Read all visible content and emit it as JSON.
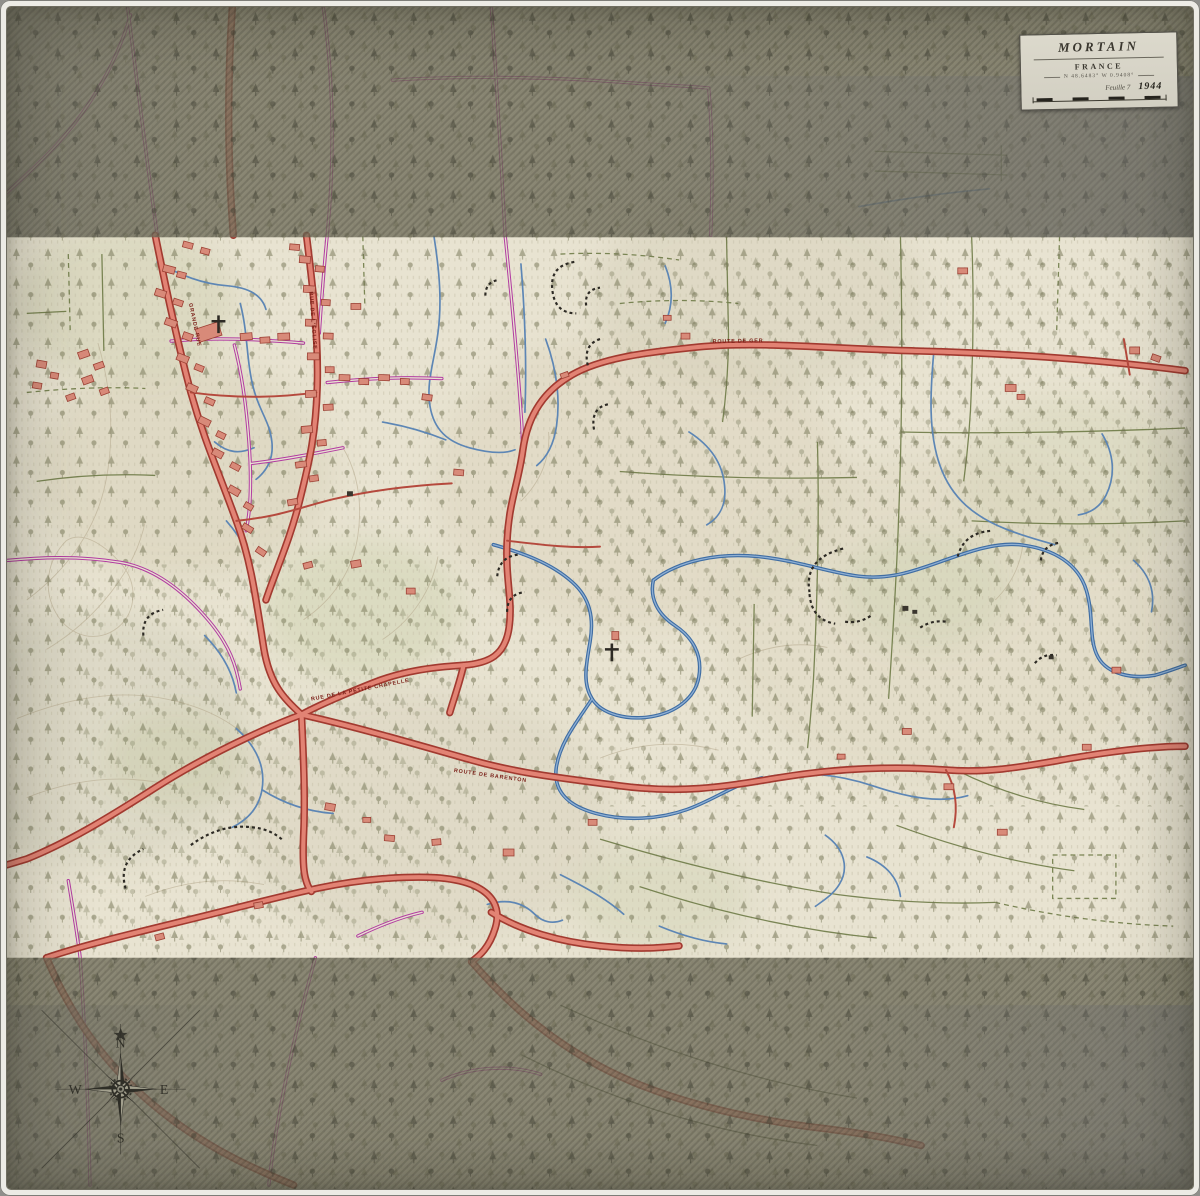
{
  "cartouche": {
    "title": "MORTAIN",
    "country": "FRANCE",
    "coordinates": "N 48.6483°  W 0.9408°",
    "edition": "Feuille 7",
    "year": "1944"
  },
  "compass": {
    "north": "N",
    "east": "E",
    "south": "S",
    "west": "W"
  },
  "road_labels": [
    {
      "text": "ROUTE DE GER"
    },
    {
      "text": "RUE DE LA PETITE CHAPELLE"
    },
    {
      "text": "ROUTE DE BARENTON"
    },
    {
      "text": "GRANDE RUE"
    },
    {
      "text": "RUE DE L'ÉGLISE"
    }
  ],
  "colors": {
    "paper": "#e8e3d1",
    "fog": "#6e6c59",
    "road_major_fill": "#e28374",
    "road_major_casing": "#a23a30",
    "road_secondary": "#b23aa1",
    "water": "#3f6da3",
    "vegetation": "#6f7050",
    "field_line": "#67753f",
    "building": "#d88a79",
    "ink": "#2f2e27"
  }
}
